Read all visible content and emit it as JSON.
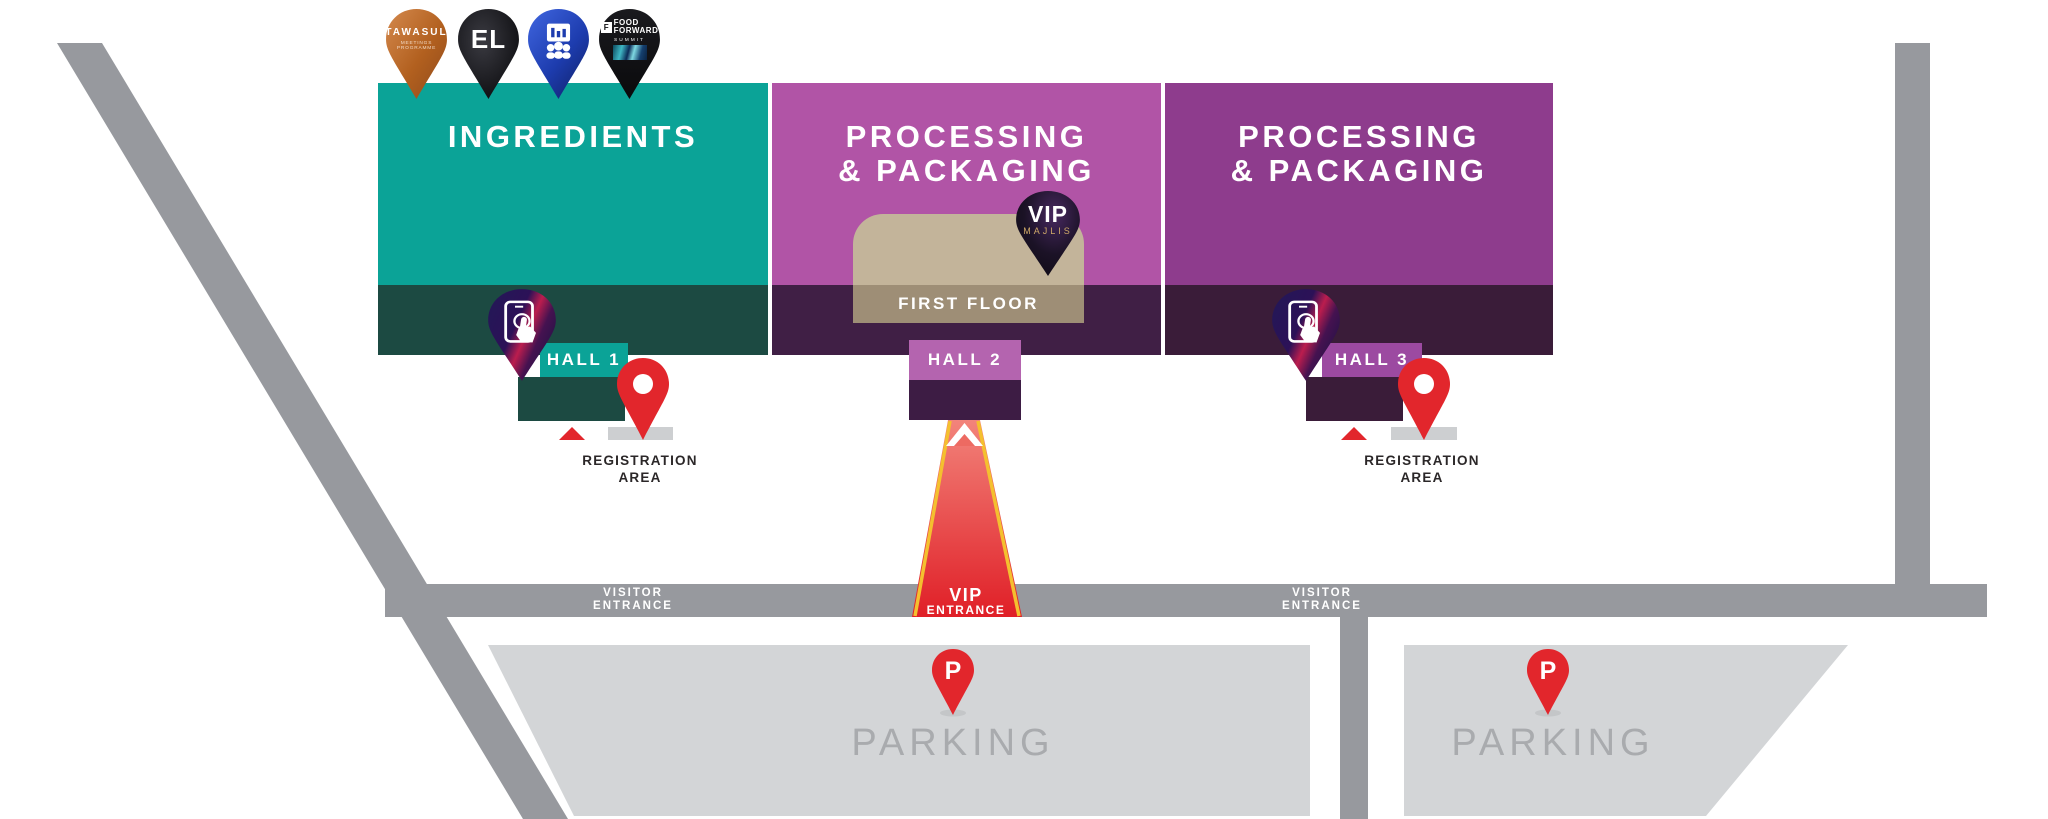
{
  "brand_pins": [
    {
      "name": "tawasul",
      "label": "TAWASUL",
      "sublabel": "MEETINGS PROGRAMME"
    },
    {
      "name": "el",
      "label": "EL"
    },
    {
      "name": "conference",
      "icon": "presentation-audience-icon"
    },
    {
      "name": "food-forward",
      "logo_letter": "F",
      "label_line1": "FOOD",
      "label_line2": "FORWARD",
      "sublabel": "SUMMIT"
    }
  ],
  "zones": {
    "ingredients": {
      "title": "INGREDIENTS"
    },
    "processing_center": {
      "title_line1": "PROCESSING",
      "title_line2": "& PACKAGING"
    },
    "processing_right": {
      "title_line1": "PROCESSING",
      "title_line2": "& PACKAGING"
    }
  },
  "first_floor_label": "FIRST FLOOR",
  "vip_majlis_pin": {
    "line1": "VIP",
    "line2": "MAJLIS"
  },
  "hall_labels": {
    "hall1": "HALL 1",
    "hall2": "HALL 2",
    "hall3": "HALL 3"
  },
  "registration_area": {
    "line1": "REGISTRATION",
    "line2": "AREA"
  },
  "vip_entrance": {
    "line1": "VIP",
    "line2": "ENTRANCE"
  },
  "visitor_entrance": {
    "line1": "VISITOR",
    "line2": "ENTRANCE"
  },
  "parking": {
    "label": "PARKING",
    "pin_letter": "P"
  },
  "colors": {
    "teal": "#0ba397",
    "teal_dark": "#1c4a42",
    "magenta": "#b154a6",
    "magenta_dark": "#401f45",
    "purple": "#8e3c8d",
    "purple_dark": "#3a1c39",
    "hall2_label": "#b464af",
    "hall3_label": "#9c4aa1",
    "tan": "#c3b49a",
    "tan_dark": "#9e8e76",
    "red": "#e2262c",
    "carpet_top_red": "#f2847b",
    "yellow": "#f4c02f",
    "road_grey": "#97999e",
    "parking_grey": "#d3d5d7",
    "parking_text_grey": "#a9abae"
  }
}
